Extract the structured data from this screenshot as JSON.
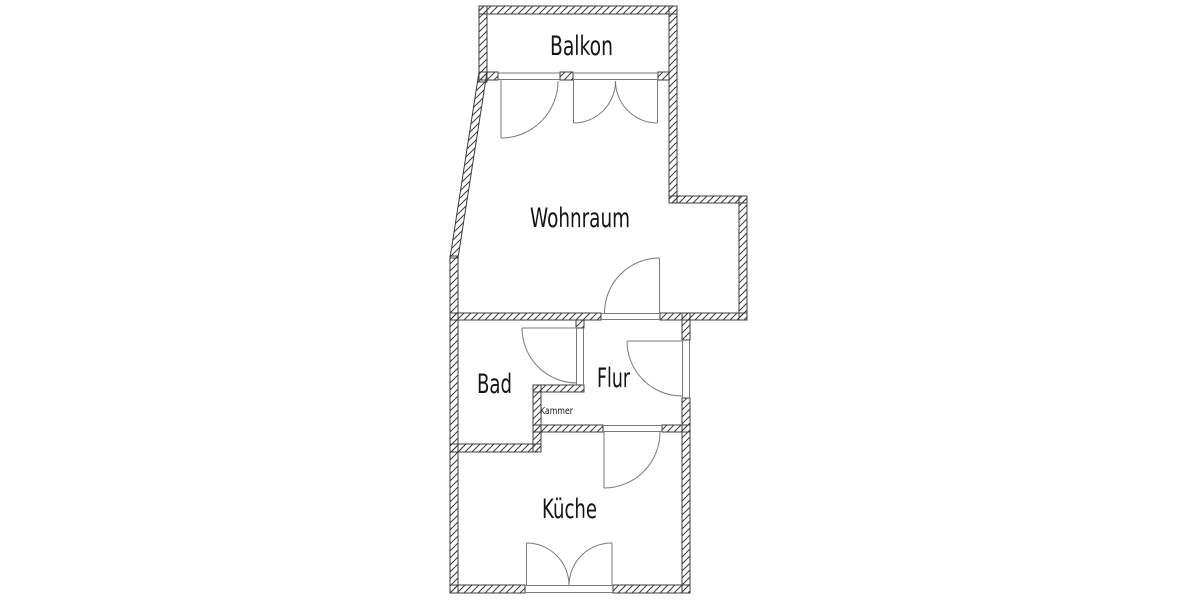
{
  "diagram": {
    "kind": "apartment-floor-plan",
    "background": "#ffffff"
  },
  "colors": {
    "wall_line": "#3c3c3c",
    "hatch_line": "#3c3c3c",
    "door_line": "#7a7a7a",
    "label_text": "#141414"
  },
  "rooms": {
    "balkon": {
      "label": "Balkon"
    },
    "wohnraum": {
      "label": "Wohnraum"
    },
    "bad": {
      "label": "Bad"
    },
    "flur": {
      "label": "Flur"
    },
    "kammer": {
      "label": "Kammer"
    },
    "kueche": {
      "label": "Küche"
    }
  }
}
